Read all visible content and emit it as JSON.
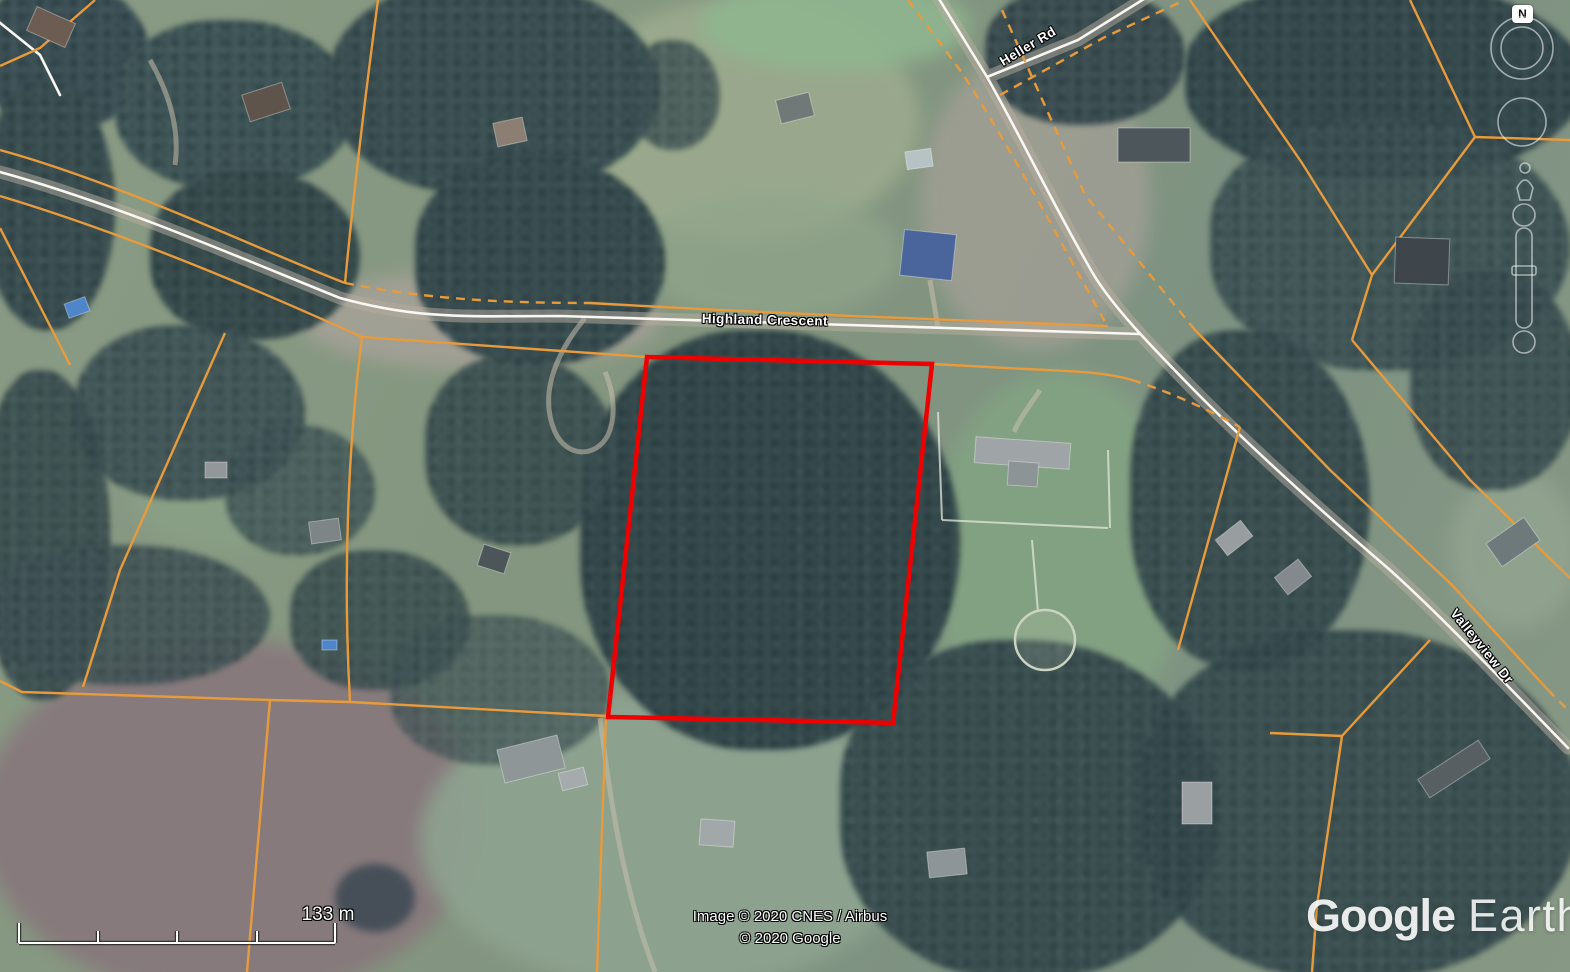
{
  "app": {
    "name": "Google Earth"
  },
  "map": {
    "road_labels": [
      {
        "id": "highland-crescent",
        "text": "Highland Crescent"
      },
      {
        "id": "heller-rd",
        "text": "Heller Rd"
      },
      {
        "id": "valleyview-dr",
        "text": "Valleyview Dr"
      }
    ],
    "property_boundary": {
      "color": "#ee0000"
    },
    "cadastral_lines": {
      "color": "#e89b3c"
    },
    "road_color": "#f8f7f3"
  },
  "navigation": {
    "compass_label": "N"
  },
  "scale_bar": {
    "label": "133 m"
  },
  "attribution": {
    "line1": "Image © 2020 CNES / Airbus",
    "line2": "© 2020 Google"
  },
  "logo": {
    "part1": "Google",
    "part2": "Earth"
  }
}
